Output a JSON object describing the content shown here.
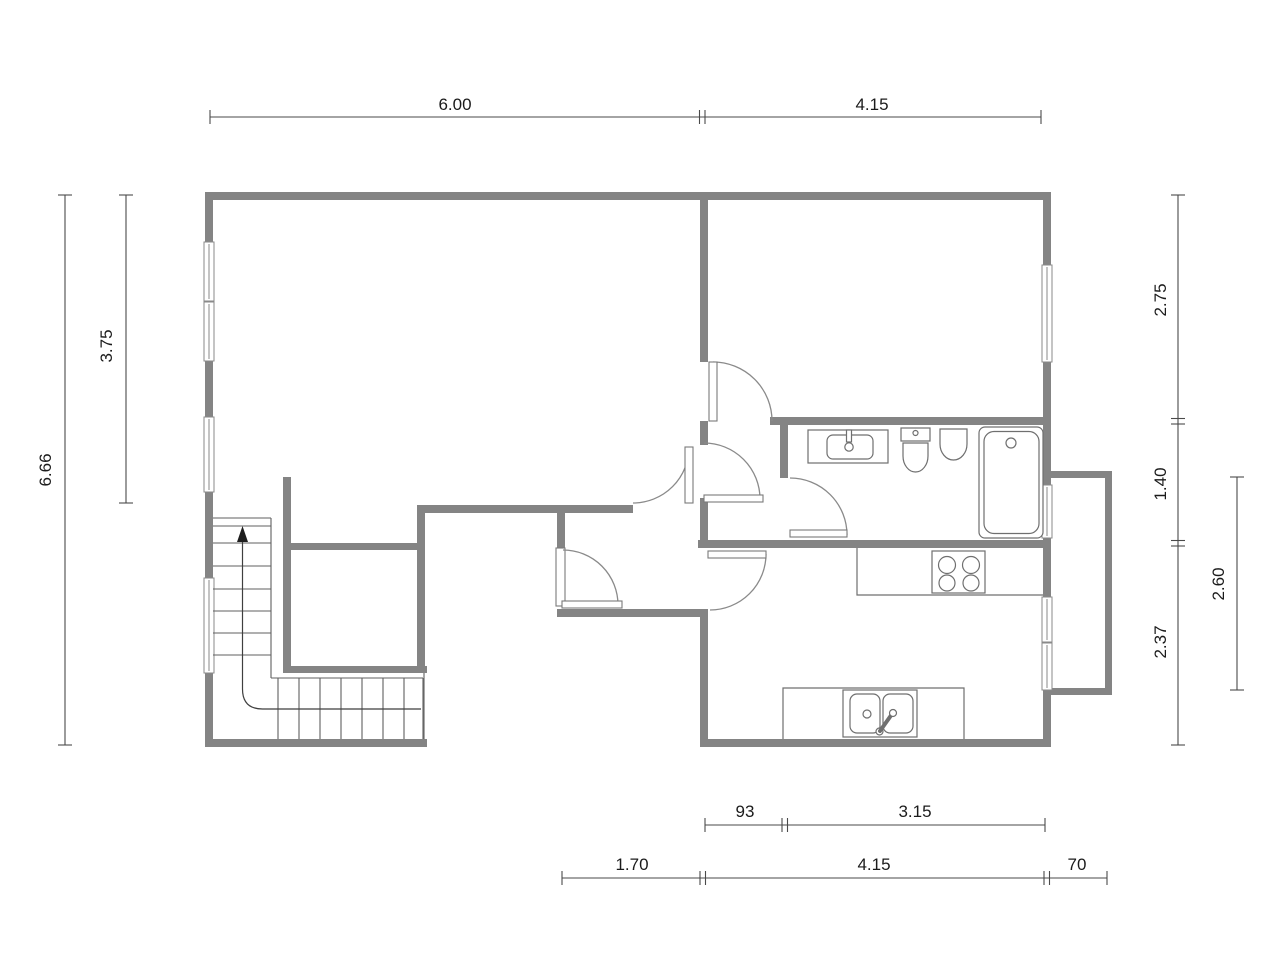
{
  "document": {
    "type": "floor-plan",
    "background": "#ffffff"
  },
  "colors": {
    "wall": "#848484",
    "fixture_line": "#6f6f6f",
    "door_arc": "#8a8a8a",
    "dimension_line": "#4a4a4a",
    "dimension_text": "#1b1b1b"
  },
  "dimensions": {
    "top": {
      "left": "6.00",
      "right": "4.15"
    },
    "left": {
      "outer": "6.66",
      "inner": "3.75"
    },
    "right": {
      "top": "2.75",
      "middle": "1.40",
      "bottom": "2.37",
      "outer": "2.60"
    },
    "bottom_upper": {
      "left": "93",
      "right": "3.15"
    },
    "bottom_lower": {
      "left": "1.70",
      "middle": "4.15",
      "right": "70"
    }
  },
  "fixtures": [
    "staircase-with-up-arrow",
    "closet",
    "bathroom-vanity-sink",
    "toilet",
    "bidet",
    "bathtub",
    "cooktop-4-burners",
    "kitchen-double-sink",
    "balcony"
  ]
}
